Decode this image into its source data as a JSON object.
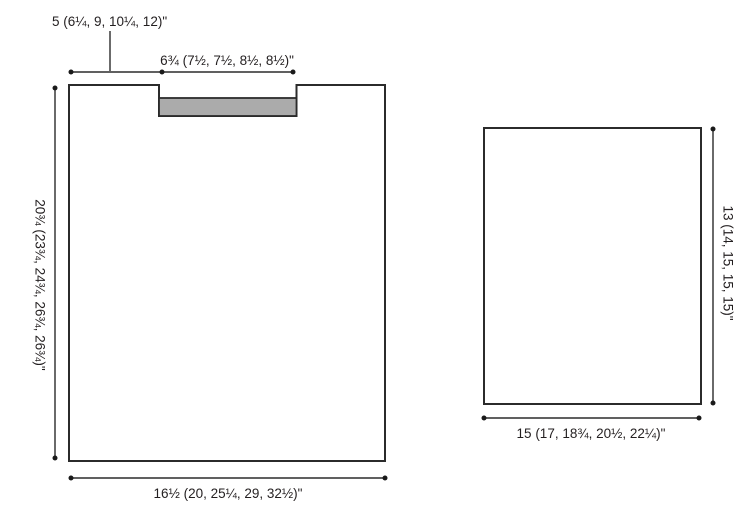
{
  "figure": {
    "left_piece": {
      "shoulder_width_label": "5 (6¼, 9, 10¼, 12)\"",
      "neck_width_label": "6¾ (7½, 7½, 8½, 8½)\"",
      "length_label": "20¾ (23¾, 24¾, 26¾, 26¾)\"",
      "bottom_width_label": "16½ (20, 25¼, 29, 32½)\""
    },
    "right_piece": {
      "length_label": "13 (14, 15, 15, 15)\"",
      "width_label": "15 (17, 18¾, 20½, 22¼)\""
    },
    "colors": {
      "line": "#2b2b2b",
      "text": "#231f20",
      "band_fill": "#ababab",
      "background": "#ffffff"
    }
  }
}
